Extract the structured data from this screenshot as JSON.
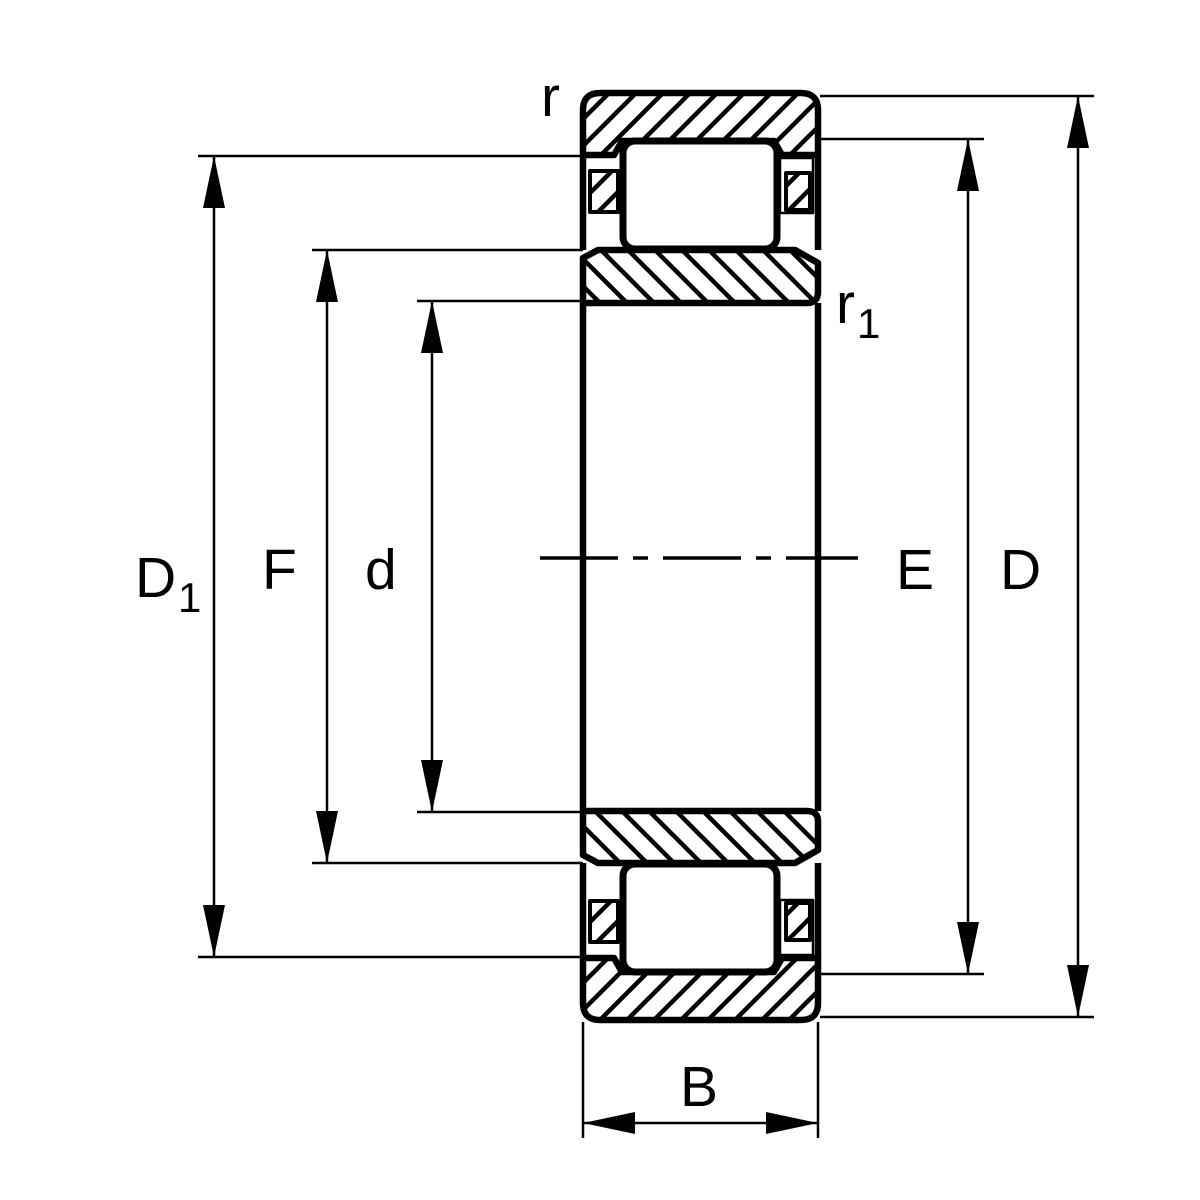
{
  "colors": {
    "ink": "#000000",
    "paper": "#ffffff"
  },
  "labels": {
    "D1": {
      "base": "D",
      "sub": "1"
    },
    "F": "F",
    "d": "d",
    "E": "E",
    "D": "D",
    "B": "B",
    "r": "r",
    "r1": {
      "base": "r",
      "sub": "1"
    }
  }
}
